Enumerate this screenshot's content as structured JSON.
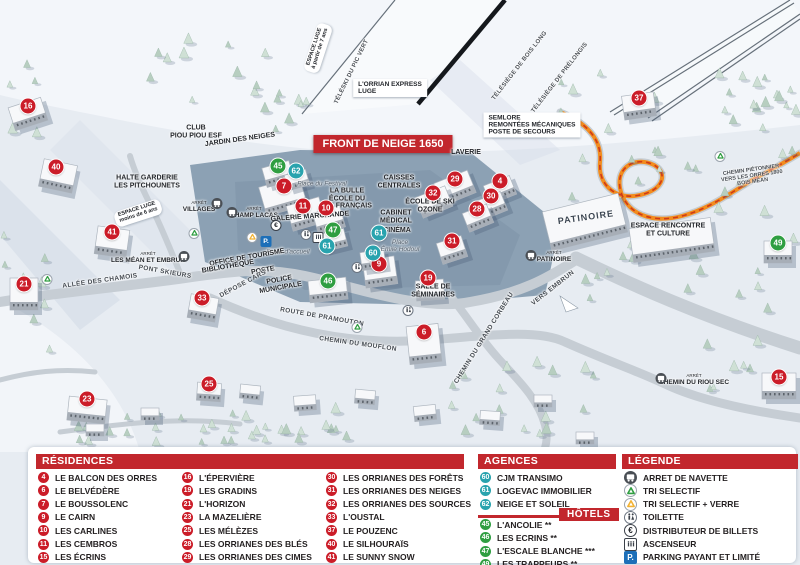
{
  "colors": {
    "accent_red": "#c2272d",
    "marker_red": "#cb1c28",
    "marker_green": "#2f9e41",
    "marker_teal": "#29a3ae",
    "parking_blue": "#1d6fb8",
    "path_orange": "#f28c1e"
  },
  "map": {
    "banner": "FRONT DE NEIGE 1650",
    "markers": [
      {
        "num": "16",
        "type": "residence",
        "x": 28,
        "y": 106
      },
      {
        "num": "40",
        "type": "residence",
        "x": 56,
        "y": 167
      },
      {
        "num": "41",
        "type": "residence",
        "x": 112,
        "y": 232
      },
      {
        "num": "21",
        "type": "residence",
        "x": 24,
        "y": 284
      },
      {
        "num": "33",
        "type": "residence",
        "x": 202,
        "y": 298
      },
      {
        "num": "23",
        "type": "residence",
        "x": 87,
        "y": 399
      },
      {
        "num": "25",
        "type": "residence",
        "x": 209,
        "y": 384
      },
      {
        "num": "7",
        "type": "residence",
        "x": 284,
        "y": 186
      },
      {
        "num": "11",
        "type": "residence",
        "x": 303,
        "y": 206
      },
      {
        "num": "10",
        "type": "residence",
        "x": 326,
        "y": 208
      },
      {
        "num": "9",
        "type": "residence",
        "x": 379,
        "y": 264
      },
      {
        "num": "19",
        "type": "residence",
        "x": 428,
        "y": 278
      },
      {
        "num": "6",
        "type": "residence",
        "x": 424,
        "y": 332
      },
      {
        "num": "29",
        "type": "residence",
        "x": 455,
        "y": 179
      },
      {
        "num": "4",
        "type": "residence",
        "x": 500,
        "y": 181
      },
      {
        "num": "32",
        "type": "residence",
        "x": 433,
        "y": 193
      },
      {
        "num": "30",
        "type": "residence",
        "x": 491,
        "y": 196
      },
      {
        "num": "28",
        "type": "residence",
        "x": 477,
        "y": 209
      },
      {
        "num": "31",
        "type": "residence",
        "x": 452,
        "y": 241
      },
      {
        "num": "37",
        "type": "residence",
        "x": 639,
        "y": 98
      },
      {
        "num": "15",
        "type": "residence",
        "x": 779,
        "y": 377
      },
      {
        "num": "45",
        "type": "hotel",
        "x": 278,
        "y": 166
      },
      {
        "num": "47",
        "type": "hotel",
        "x": 333,
        "y": 230
      },
      {
        "num": "46",
        "type": "hotel",
        "x": 328,
        "y": 281
      },
      {
        "num": "49",
        "type": "hotel",
        "x": 778,
        "y": 243
      },
      {
        "num": "62",
        "type": "agency",
        "x": 296,
        "y": 171
      },
      {
        "num": "61",
        "type": "agency",
        "x": 327,
        "y": 246
      },
      {
        "num": "61",
        "type": "agency",
        "x": 379,
        "y": 233
      },
      {
        "num": "60",
        "type": "agency",
        "x": 373,
        "y": 253
      }
    ],
    "labels": [
      {
        "text": "ESPACE LUGE|à partir de 7 ans",
        "x": 318,
        "y": 48,
        "rot": -72,
        "cls": "pill"
      },
      {
        "text": "TÉLÉSKI DU PIC VERT",
        "x": 352,
        "y": 72,
        "rot": -64,
        "cls": "lift"
      },
      {
        "text": "L'ORRIAN EXPRESS|LUGE",
        "x": 390,
        "y": 88,
        "rot": 0,
        "cls": "box"
      },
      {
        "text": "TÉLÉSIÈGE DE BOIS LONG",
        "x": 520,
        "y": 66,
        "rot": -52,
        "cls": "lift"
      },
      {
        "text": "TÉLÉSIÈGE DE PRÉLONGIS",
        "x": 560,
        "y": 78,
        "rot": -52,
        "cls": "lift"
      },
      {
        "text": "SEMLORE|REMONTÉES MÉCANIQUES|POSTE DE SECOURS",
        "x": 532,
        "y": 125,
        "rot": 0,
        "cls": "box"
      },
      {
        "text": "CLUB|PIOU PIOU ESF",
        "x": 196,
        "y": 132,
        "rot": 0,
        "cls": "poi"
      },
      {
        "text": "JARDIN DES NEIGES",
        "x": 240,
        "y": 140,
        "rot": -8,
        "cls": "poi"
      },
      {
        "text": "HALTE GARDERIE|LES PITCHOUNETS",
        "x": 147,
        "y": 182,
        "rot": 0,
        "cls": "poi"
      },
      {
        "text": "ESPACE LUGE|moins de 6 ans",
        "x": 138,
        "y": 213,
        "rot": -18,
        "cls": "pill"
      },
      {
        "text": "ARRÊT|VILLAGES",
        "x": 199,
        "y": 207,
        "rot": 0,
        "cls": "stop"
      },
      {
        "text": "ARRÊT|CHAMP LACAS",
        "x": 254,
        "y": 213,
        "rot": 0,
        "cls": "stop"
      },
      {
        "text": "GALERIE MARCHANDE",
        "x": 310,
        "y": 217,
        "rot": -4,
        "cls": "poi"
      },
      {
        "text": "Place du Festival",
        "x": 322,
        "y": 184,
        "rot": 0,
        "cls": "place"
      },
      {
        "text": "LA BULLE|ÉCOLE DU|SKI FRANÇAIS",
        "x": 347,
        "y": 199,
        "rot": 0,
        "cls": "poi"
      },
      {
        "text": "CAISSES|CENTRALES",
        "x": 399,
        "y": 182,
        "rot": 0,
        "cls": "poi"
      },
      {
        "text": "CABINET|MÉDICAL",
        "x": 396,
        "y": 217,
        "rot": 0,
        "cls": "poi"
      },
      {
        "text": "CINÉMA",
        "x": 397,
        "y": 231,
        "rot": 0,
        "cls": "poi"
      },
      {
        "text": "Place|Émile Hodoul",
        "x": 400,
        "y": 246,
        "rot": 0,
        "cls": "place"
      },
      {
        "text": "ÉCOLE DE SKI|OZONE",
        "x": 430,
        "y": 206,
        "rot": 0,
        "cls": "poi"
      },
      {
        "text": "LAVERIE",
        "x": 466,
        "y": 153,
        "rot": 0,
        "cls": "poi"
      },
      {
        "text": "Place d'accueil",
        "x": 288,
        "y": 252,
        "rot": 0,
        "cls": "place"
      },
      {
        "text": "OFFICE DE TOURISME",
        "x": 247,
        "y": 258,
        "rot": -10,
        "cls": "poi"
      },
      {
        "text": "BIBLIOTHÈQUE",
        "x": 228,
        "y": 267,
        "rot": -10,
        "cls": "poi"
      },
      {
        "text": "POSTE",
        "x": 263,
        "y": 271,
        "rot": -10,
        "cls": "poi"
      },
      {
        "text": "POLICE|MUNICIPALE",
        "x": 280,
        "y": 284,
        "rot": -10,
        "cls": "poi"
      },
      {
        "text": "DÉPOSE CARS",
        "x": 243,
        "y": 284,
        "rot": -28,
        "cls": "road"
      },
      {
        "text": "ALLÉE DES CHAMOIS",
        "x": 100,
        "y": 281,
        "rot": -8,
        "cls": "road"
      },
      {
        "text": "PONT SKIEURS",
        "x": 165,
        "y": 272,
        "rot": 10,
        "cls": "road"
      },
      {
        "text": "ARRÊT|LES MÉAN ET EMBRUN",
        "x": 148,
        "y": 258,
        "rot": 0,
        "cls": "stop"
      },
      {
        "text": "ROUTE DE PRAMOUTON",
        "x": 322,
        "y": 317,
        "rot": 10,
        "cls": "road"
      },
      {
        "text": "CHEMIN DU MOUFLON",
        "x": 358,
        "y": 344,
        "rot": 8,
        "cls": "road"
      },
      {
        "text": "CHEMIN DU GRAND CORBEAU",
        "x": 484,
        "y": 338,
        "rot": -58,
        "cls": "road"
      },
      {
        "text": "SALLE DE|SÉMINAIRES",
        "x": 433,
        "y": 291,
        "rot": 0,
        "cls": "poi"
      },
      {
        "text": "VERS EMBRUN",
        "x": 553,
        "y": 288,
        "rot": -38,
        "cls": "road"
      },
      {
        "text": "ARRÊT|PATINOIRE",
        "x": 554,
        "y": 257,
        "rot": 0,
        "cls": "stop"
      },
      {
        "text": "PATINOIRE",
        "x": 586,
        "y": 218,
        "rot": -8,
        "cls": "poibig"
      },
      {
        "text": "ESPACE RENCONTRE|ET CULTURE",
        "x": 668,
        "y": 230,
        "rot": 0,
        "cls": "poi"
      },
      {
        "text": "CHEMIN PIÉTONNIER|VERS LES ORRES 1800|BOIS MÉAN",
        "x": 752,
        "y": 177,
        "rot": -8,
        "cls": "tiny"
      },
      {
        "text": "ARRÊT|CHEMIN DU RIOU SEC",
        "x": 694,
        "y": 380,
        "rot": 0,
        "cls": "stop"
      }
    ],
    "icons": [
      {
        "name": "bus-icon",
        "x": 217,
        "y": 205
      },
      {
        "name": "bus-icon",
        "x": 232,
        "y": 214
      },
      {
        "name": "bus-icon",
        "x": 184,
        "y": 258
      },
      {
        "name": "bus-icon",
        "x": 531,
        "y": 257
      },
      {
        "name": "bus-icon",
        "x": 661,
        "y": 380
      },
      {
        "name": "recycle-green-icon",
        "x": 194,
        "y": 233
      },
      {
        "name": "recycle-green-icon",
        "x": 47,
        "y": 279
      },
      {
        "name": "recycle-green-icon",
        "x": 357,
        "y": 327
      },
      {
        "name": "recycle-green-icon",
        "x": 720,
        "y": 156
      },
      {
        "name": "recycle-yellow-icon",
        "x": 252,
        "y": 237
      },
      {
        "name": "parking-icon",
        "x": 266,
        "y": 239
      },
      {
        "name": "euro-icon",
        "x": 276,
        "y": 223
      },
      {
        "name": "wc-icon",
        "x": 306,
        "y": 234
      },
      {
        "name": "wc-icon",
        "x": 357,
        "y": 267
      },
      {
        "name": "wc-icon",
        "x": 408,
        "y": 310
      },
      {
        "name": "elevator-icon",
        "x": 318,
        "y": 237
      }
    ]
  },
  "legend": {
    "residences": {
      "title": "RÉSIDENCES",
      "items": [
        {
          "num": "4",
          "label": "LE BALCON DES ORRES"
        },
        {
          "num": "6",
          "label": "LE BELVÉDÈRE"
        },
        {
          "num": "7",
          "label": "LE BOUSSOLENC"
        },
        {
          "num": "9",
          "label": "LE CAIRN"
        },
        {
          "num": "10",
          "label": "LES CARLINES"
        },
        {
          "num": "11",
          "label": "LES CEMBROS"
        },
        {
          "num": "15",
          "label": "LES ÉCRINS"
        },
        {
          "num": "16",
          "label": "L'ÉPERVIÈRE"
        },
        {
          "num": "19",
          "label": "LES GRADINS"
        },
        {
          "num": "21",
          "label": "L'HORIZON"
        },
        {
          "num": "23",
          "label": "LA MAZELIÈRE"
        },
        {
          "num": "25",
          "label": "LES MÉLÈZES"
        },
        {
          "num": "28",
          "label": "LES ORRIANES DES BLÉS"
        },
        {
          "num": "29",
          "label": "LES ORRIANES DES CIMES"
        },
        {
          "num": "30",
          "label": "LES ORRIANES DES FORÊTS"
        },
        {
          "num": "31",
          "label": "LES ORRIANES DES NEIGES"
        },
        {
          "num": "32",
          "label": "LES ORRIANES DES SOURCES"
        },
        {
          "num": "33",
          "label": "L'OUSTAL"
        },
        {
          "num": "37",
          "label": "LE POUZENC"
        },
        {
          "num": "40",
          "label": "LE SILHOURAÏS"
        },
        {
          "num": "41",
          "label": "LE SUNNY SNOW"
        }
      ]
    },
    "agencies": {
      "title": "AGENCES IMMOBILIÈRES",
      "items": [
        {
          "num": "60",
          "label": "CJM TRANSIMO"
        },
        {
          "num": "61",
          "label": "LOGEVAC IMMOBILIER"
        },
        {
          "num": "62",
          "label": "NEIGE ET SOLEIL"
        }
      ]
    },
    "hotels": {
      "title": "HÔTELS",
      "items": [
        {
          "num": "45",
          "label": "L'ANCOLIE **"
        },
        {
          "num": "46",
          "label": "LES ECRINS **"
        },
        {
          "num": "47",
          "label": "L'ESCALE BLANCHE ***"
        },
        {
          "num": "49",
          "label": "LES TRAPPEURS **"
        }
      ]
    },
    "legende": {
      "title": "LÉGENDE",
      "items": [
        {
          "icon": "bus-icon",
          "label": "ARRET DE NAVETTE"
        },
        {
          "icon": "recycle-green-icon",
          "label": "TRI SELECTIF"
        },
        {
          "icon": "recycle-yellow-icon",
          "label": "TRI SELECTIF + VERRE"
        },
        {
          "icon": "wc-icon",
          "label": "TOILETTE"
        },
        {
          "icon": "euro-icon",
          "label": "DISTRIBUTEUR DE BILLETS"
        },
        {
          "icon": "elevator-icon",
          "label": "ASCENSEUR"
        },
        {
          "icon": "parking-icon",
          "label": "PARKING PAYANT ET LIMITÉ"
        }
      ]
    }
  }
}
